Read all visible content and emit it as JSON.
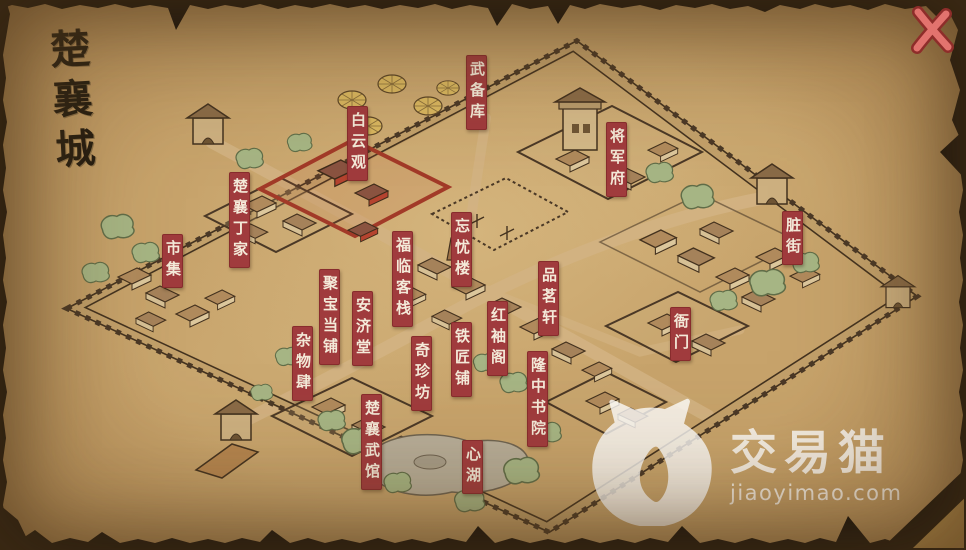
{
  "title": {
    "text": "楚襄城"
  },
  "close_button": {
    "icon": "close-x-icon"
  },
  "map": {
    "labels": [
      {
        "id": "wubeiku",
        "text": "武备库"
      },
      {
        "id": "baiyunguan",
        "text": "白云观"
      },
      {
        "id": "jiangjunfu",
        "text": "将军府"
      },
      {
        "id": "chuxiang-dingjia",
        "text": "楚襄丁家"
      },
      {
        "id": "shiji",
        "text": "市集"
      },
      {
        "id": "zangjie",
        "text": "脏街"
      },
      {
        "id": "wangyoulou",
        "text": "忘忧楼"
      },
      {
        "id": "fulin-kezhan",
        "text": "福临客栈"
      },
      {
        "id": "pinmingxuan",
        "text": "品茗轩"
      },
      {
        "id": "hongxiuge",
        "text": "红袖阁"
      },
      {
        "id": "tiejiangpu",
        "text": "铁匠铺"
      },
      {
        "id": "jubao-dangpu",
        "text": "聚宝当铺"
      },
      {
        "id": "anjitang",
        "text": "安济堂"
      },
      {
        "id": "zawusi",
        "text": "杂物肆"
      },
      {
        "id": "qizhenfang",
        "text": "奇珍坊"
      },
      {
        "id": "longzhong-shuyuan",
        "text": "隆中书院"
      },
      {
        "id": "yamen",
        "text": "衙门"
      },
      {
        "id": "chuxiang-wuguan",
        "text": "楚襄武馆"
      },
      {
        "id": "xinhu",
        "text": "心湖"
      }
    ]
  },
  "watermark": {
    "brand": "交易猫",
    "domain": "jiaoyimao.com"
  },
  "colors": {
    "label_bg": "#a03b3d",
    "label_text": "#f4ead9",
    "parchment": "#c09a63",
    "ink": "#43311e",
    "close_x": "#e2736e",
    "roof": "#b08a5c",
    "tree": "#a6b584",
    "temple_red": "#b5432f",
    "lake": "#b7ad98"
  }
}
